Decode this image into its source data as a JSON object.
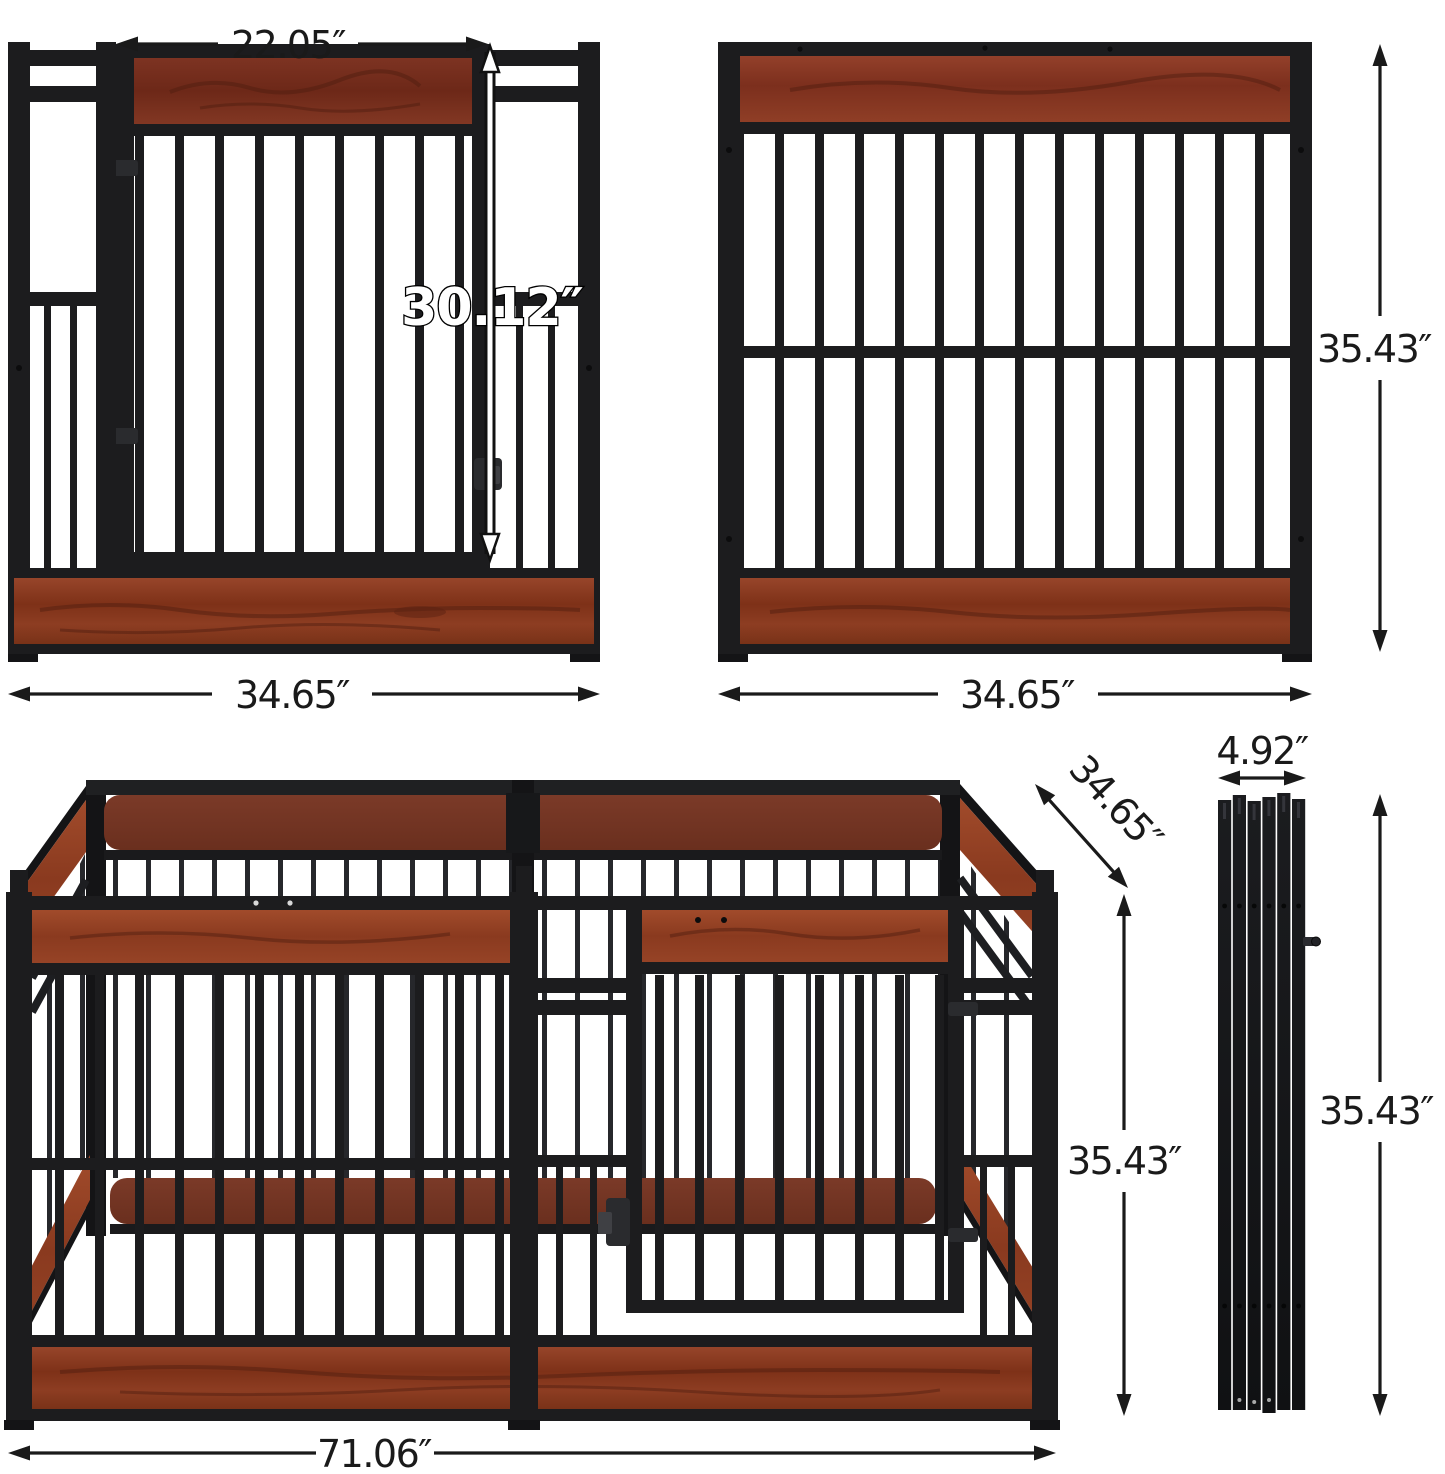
{
  "dimensions": {
    "door_panel": {
      "door_width": "22.05″",
      "door_height": "30.12″",
      "panel_width": "34.65″"
    },
    "plain_panel": {
      "panel_height": "35.43″",
      "panel_width": "34.65″"
    },
    "assembled_pen": {
      "overall_width": "71.06″",
      "side_depth": "34.65″",
      "height": "35.43″"
    },
    "folded_stack": {
      "stack_width": "4.92″",
      "stack_height": "35.43″"
    }
  },
  "colors": {
    "background": "#ffffff",
    "metal": "#1c1c1e",
    "metal_dark": "#141416",
    "metal_mid": "#2a2b2e",
    "wood": "#8a3a24",
    "wood_dark": "#6e2b18",
    "wood_light": "#9c4a2c",
    "dimension": "#1a1a1a",
    "outline_label_fill": "#ffffff",
    "outline_label_stroke": "#000000"
  }
}
